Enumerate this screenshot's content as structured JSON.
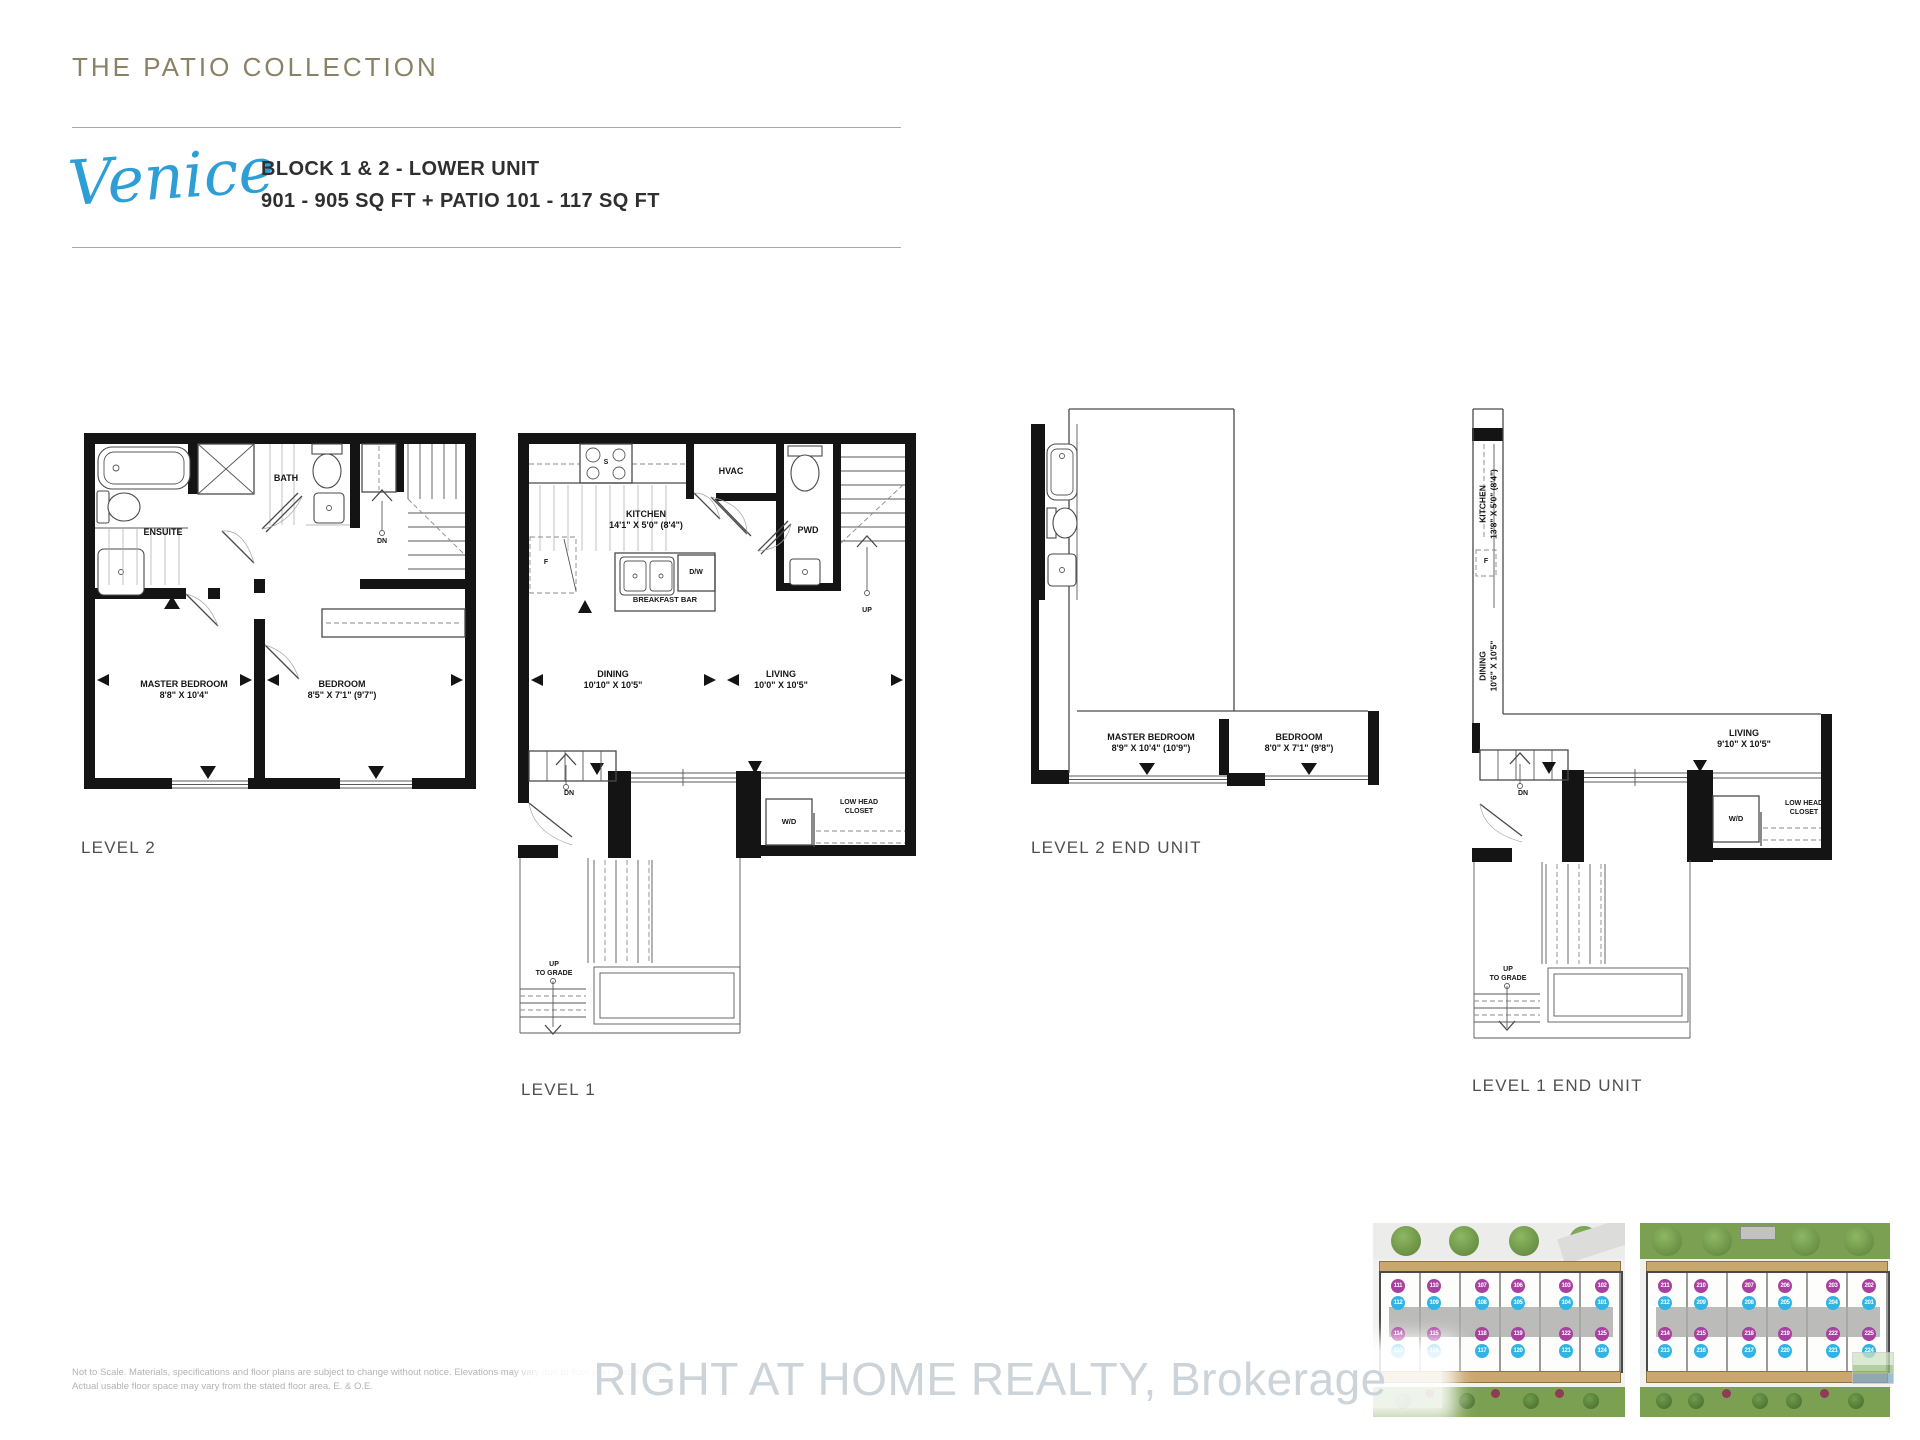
{
  "page": {
    "collection_title": "THE PATIO COLLECTION",
    "model_name": "Venice",
    "subtitle_line1": "BLOCK 1 & 2 - LOWER UNIT",
    "subtitle_line2": "901 - 905 SQ FT + PATIO 101 - 117 SQ FT",
    "watermark": "RIGHT AT HOME REALTY, Brokerage",
    "disclaimer_line1": "Not to Scale. Materials, specifications and floor plans are subject to change without notice.  Elevations may vary due to floor plan specifications.",
    "disclaimer_line2": "Actual usable floor space may vary from the stated floor area. E. & O.E.",
    "accent_blue": "#2e9fd6",
    "accent_olive": "#8b8266"
  },
  "plans": {
    "level2": {
      "label": "LEVEL 2",
      "rooms": {
        "ensuite": "ENSUITE",
        "bath": "BATH",
        "dn": "DN",
        "master": {
          "name": "MASTER BEDROOM",
          "dims": "8'8\" X 10'4\""
        },
        "bedroom": {
          "name": "BEDROOM",
          "dims": "8'5\" X 7'1\" (9'7\")"
        }
      }
    },
    "level1": {
      "label": "LEVEL 1",
      "rooms": {
        "kitchen": {
          "name": "KITCHEN",
          "dims": "14'1\" X 5'0\" (8'4\")"
        },
        "hvac": "HVAC",
        "pwd": "PWD",
        "stove": "S",
        "fridge": "F",
        "dw": "D/W",
        "breakfast_bar": "BREAKFAST BAR",
        "up": "UP",
        "dn": "DN",
        "dining": {
          "name": "DINING",
          "dims": "10'10\" X 10'5\""
        },
        "living": {
          "name": "LIVING",
          "dims": "10'0\" X 10'5\""
        },
        "wd": "W/D",
        "low_head_closet_1": "LOW HEAD",
        "low_head_closet_2": "CLOSET",
        "up_to_grade_1": "UP",
        "up_to_grade_2": "TO GRADE"
      }
    },
    "level2_end": {
      "label": "LEVEL 2 END UNIT",
      "rooms": {
        "master": {
          "name": "MASTER BEDROOM",
          "dims": "8'9\" X 10'4\" (10'9\")"
        },
        "bedroom": {
          "name": "BEDROOM",
          "dims": "8'0\" X 7'1\" (9'8\")"
        }
      }
    },
    "level1_end": {
      "label": "LEVEL 1 END UNIT",
      "rooms": {
        "kitchen": {
          "name": "KITCHEN",
          "dims": "13'8\" X 5'0\" (8'4\")"
        },
        "fridge": "F",
        "dining": {
          "name": "DINING",
          "dims": "10'6\" X 10'5\""
        },
        "living": {
          "name": "LIVING",
          "dims": "9'10\" X 10'5\""
        },
        "dn": "DN",
        "wd": "W/D",
        "low_head_closet_1": "LOW HEAD",
        "low_head_closet_2": "CLOSET",
        "up_to_grade_1": "UP",
        "up_to_grade_2": "TO GRADE"
      }
    }
  },
  "siteplans": {
    "unit_magenta": "#a93f9f",
    "unit_cyan": "#31b4e4",
    "blocks": [
      {
        "rows": [
          {
            "color": "magenta",
            "units": [
              "111",
              "110",
              "107",
              "106",
              "103",
              "102"
            ]
          },
          {
            "color": "cyan",
            "units": [
              "112",
              "109",
              "108",
              "105",
              "104",
              "101"
            ]
          },
          {
            "color": "magenta",
            "units": [
              "114",
              "115",
              "118",
              "119",
              "122",
              "125"
            ]
          },
          {
            "color": "cyan",
            "units": [
              "113",
              "116",
              "117",
              "120",
              "121",
              "124"
            ]
          }
        ]
      },
      {
        "rows": [
          {
            "color": "magenta",
            "units": [
              "211",
              "210",
              "207",
              "206",
              "203",
              "202"
            ]
          },
          {
            "color": "cyan",
            "units": [
              "212",
              "209",
              "208",
              "205",
              "204",
              "201"
            ]
          },
          {
            "color": "magenta",
            "units": [
              "214",
              "215",
              "218",
              "219",
              "222",
              "225"
            ]
          },
          {
            "color": "cyan",
            "units": [
              "213",
              "216",
              "217",
              "220",
              "221",
              "224"
            ]
          }
        ]
      }
    ]
  }
}
